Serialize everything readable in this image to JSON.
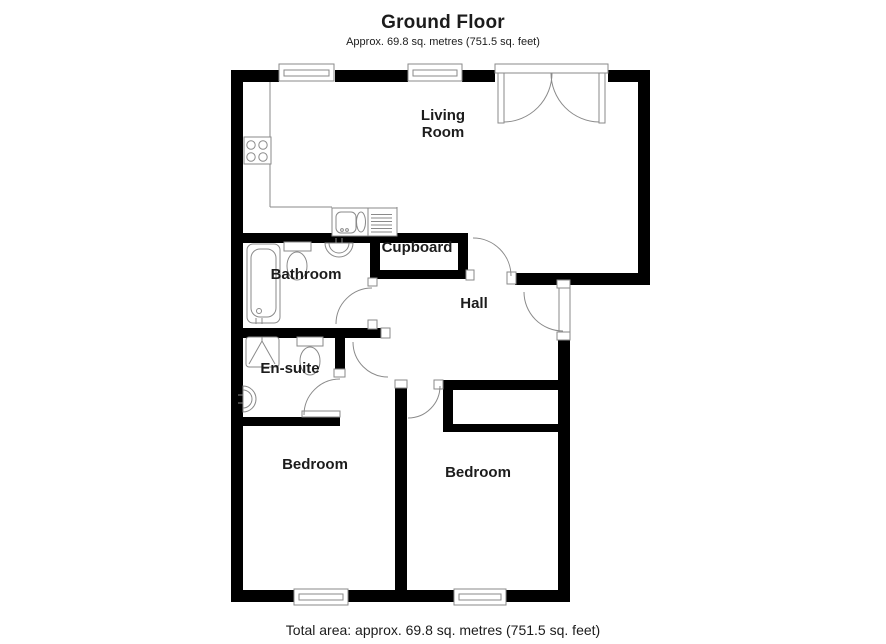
{
  "title": "Ground Floor",
  "subtitle": "Approx. 69.8 sq. metres (751.5 sq. feet)",
  "footer": "Total area: approx. 69.8 sq. metres (751.5 sq. feet)",
  "rooms": {
    "living_room": "Living Room",
    "cupboard": "Cupboard",
    "bathroom": "Bathroom",
    "hall": "Hall",
    "ensuite": "En-suite",
    "bedroom_left": "Bedroom",
    "bedroom_right": "Bedroom"
  },
  "colors": {
    "wall": "#000000",
    "line": "#8a8a8a",
    "text": "#1c1c1c",
    "background": "#ffffff"
  }
}
